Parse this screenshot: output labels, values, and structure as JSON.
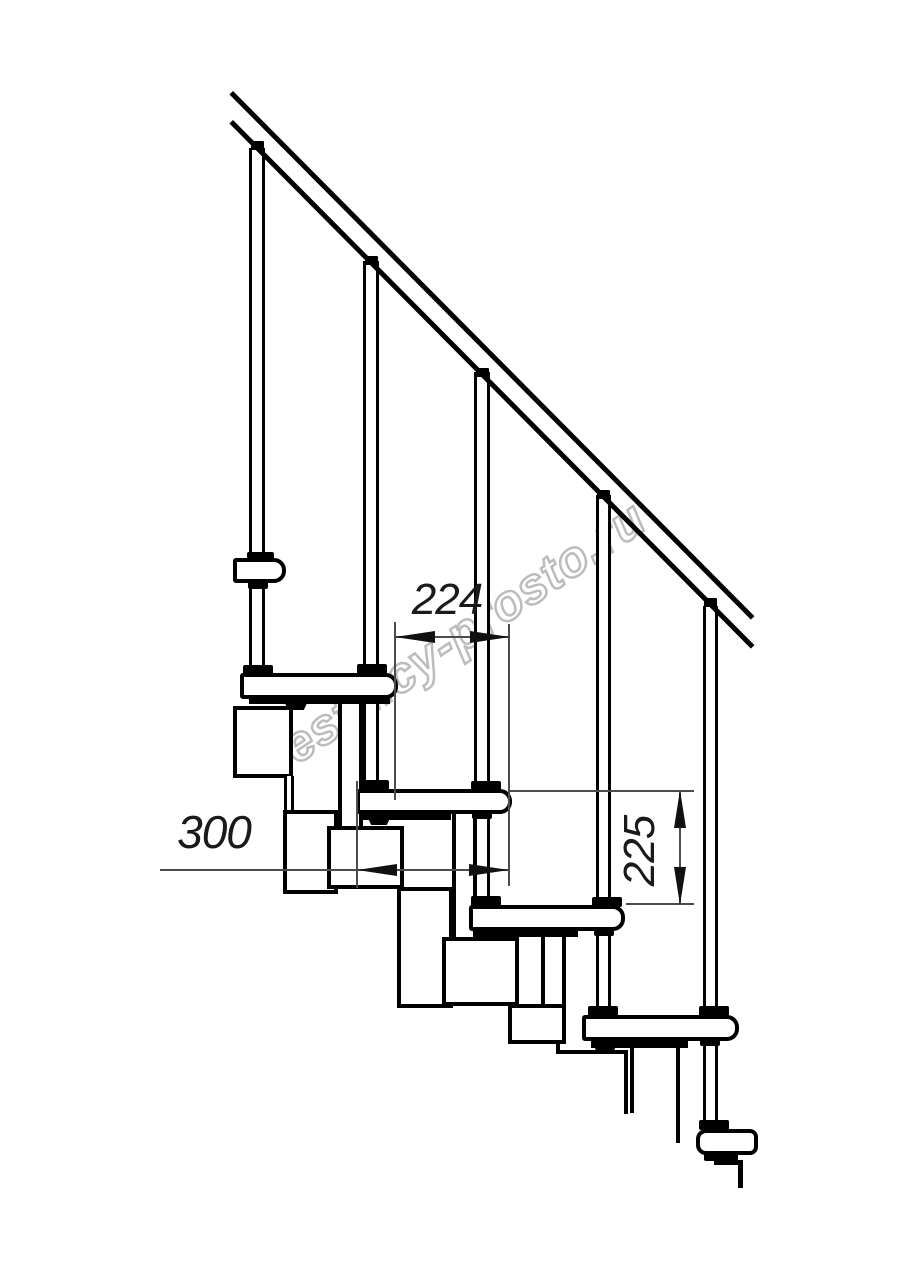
{
  "drawing": {
    "type": "modular-staircase-side-view-blueprint",
    "watermark": {
      "text": "lestnicy-prosto.ru",
      "color": "#bcbcbc"
    },
    "dims": {
      "run": {
        "value": "224",
        "orientation": "horizontal"
      },
      "depth": {
        "value": "300",
        "orientation": "horizontal"
      },
      "riser": {
        "value": "225",
        "orientation": "vertical"
      }
    },
    "colors": {
      "line": "#000000",
      "dim_line": "#4d4d4d",
      "background": "#ffffff"
    }
  }
}
